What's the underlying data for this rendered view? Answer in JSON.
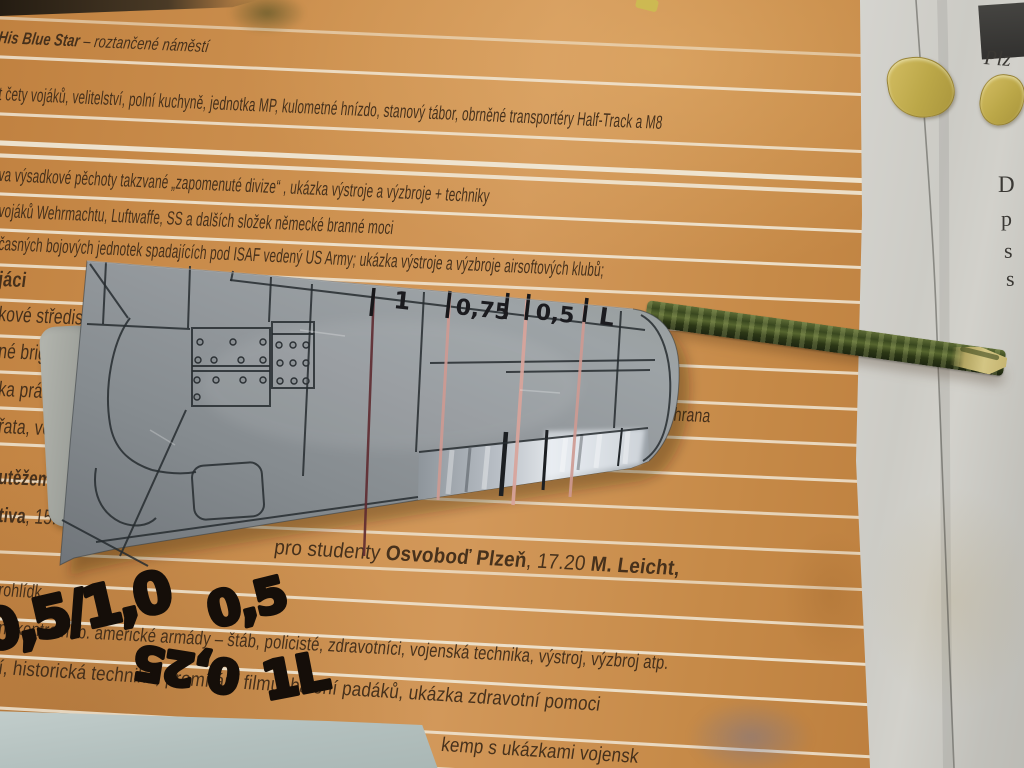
{
  "poster": {
    "background_color": "#c98e4e",
    "line1": {
      "bold": "His Blue Star",
      "rest": " – roztančené náměstí"
    },
    "line2": "t čety vojáků, velitelství, polní kuchyně, jednotka MP, kulometné hnízdo, stanový tábor, obrněné transportéry Half-Track a M8",
    "line3": "va výsadkové pěchoty takzvané „zapomenuté divize“ , ukázka výstroje a výzbroje + techniky",
    "line4": "vojáků Wehrmachtu, Luftwaffe, SS a dalších složek německé branné moci",
    "line5": "časných bojových jednotek spadajících pod ISAF vedený US Army; ukázka výstroje a výzbroje airsoftových klubů;",
    "fragments": [
      "jáci",
      "kové středis",
      "né brigá",
      "ka práce",
      "řata, vo",
      "utěžemi"
    ],
    "fragment_tiva": {
      "bold": "tiva",
      "rest": ", 15."
    },
    "zachrana": "áchrana",
    "students_line": {
      "pre": "pro studenty ",
      "bold1": "Osvoboď Plzeň",
      "mid": ", 17.20 ",
      "bold2": "M. Leicht,"
    },
    "line9": "rohlídk",
    "line10": "n, kontrolní b. americké armády – štáb, policisté, zdravotníci, vojenská technika, výstroj, výzbroj atp.",
    "line11": "í, historická technika, promítání filmů, balení padáků, ukázka zdravotní pomoci",
    "line12": "kemp s ukázkami vojensk"
  },
  "wing_markings": {
    "labels": [
      "1",
      "0,75",
      "0,5",
      "L"
    ],
    "scribe_line_color": "#d9a49b",
    "marker_color": "#17171a"
  },
  "paper_handwriting": {
    "group1": "0,5/1,0",
    "group2": "0,5",
    "group3_rotated": "0,25",
    "group4": "1L",
    "color": "#150e09"
  },
  "newspaper": {
    "headline_fragment": "Plz",
    "column_letters": [
      "D",
      "p",
      "s",
      "s"
    ]
  },
  "materials": {
    "wing_color": "#8b9194",
    "flap_silver": "#e2e6ea",
    "stick_green": "#39471f",
    "card_color": "#b6c3c1"
  }
}
